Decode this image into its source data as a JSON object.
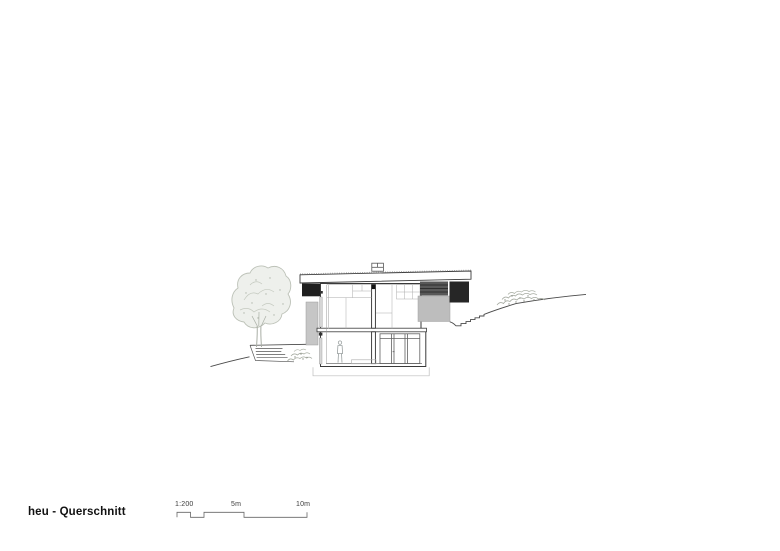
{
  "titleblock": {
    "title": "heu - Querschnitt"
  },
  "scalebar": {
    "ratio_label": "1:200",
    "mid_label": "5m",
    "end_label": "10m"
  },
  "drawing": {
    "type": "architectural-section",
    "colors": {
      "linework": "#3a3a3a",
      "canopy_black": "#1f1f1f",
      "facade_gray": "#bdbdbd",
      "retaining_gray": "#c6c6c6",
      "foliage_gray": "#b7bcb2"
    }
  }
}
